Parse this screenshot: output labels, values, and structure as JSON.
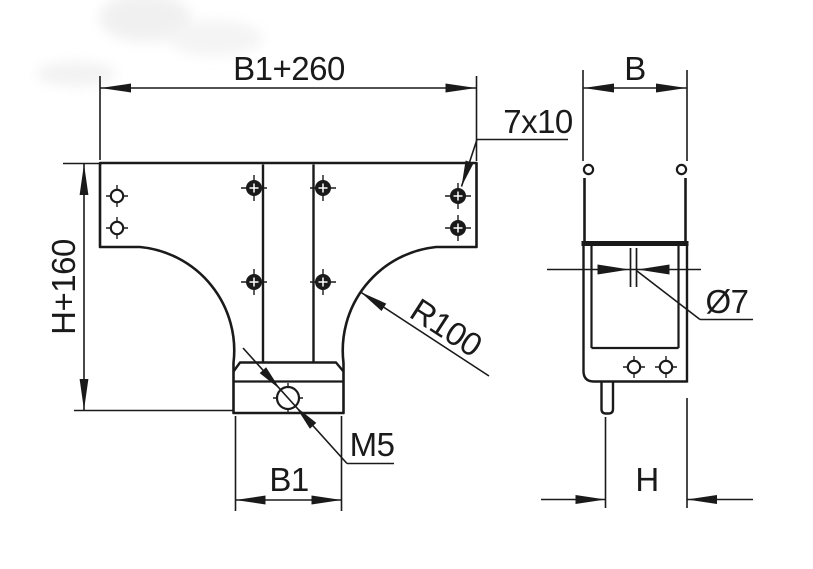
{
  "drawing": {
    "type": "technical-drawing",
    "description": "Two orthographic views of a T-branch cable tray cover piece",
    "colors": {
      "line": "#1a1a1a",
      "background": "#ffffff",
      "watermark": "#ededed"
    },
    "dimensions": {
      "overall_width": "B1+260",
      "slot": "7x10",
      "overall_height": "H+160",
      "fillet_radius": "R100",
      "thread": "M5",
      "stem_width": "B1",
      "tray_width": "B",
      "hole_diameter": "Ø7",
      "tray_height": "H"
    }
  }
}
